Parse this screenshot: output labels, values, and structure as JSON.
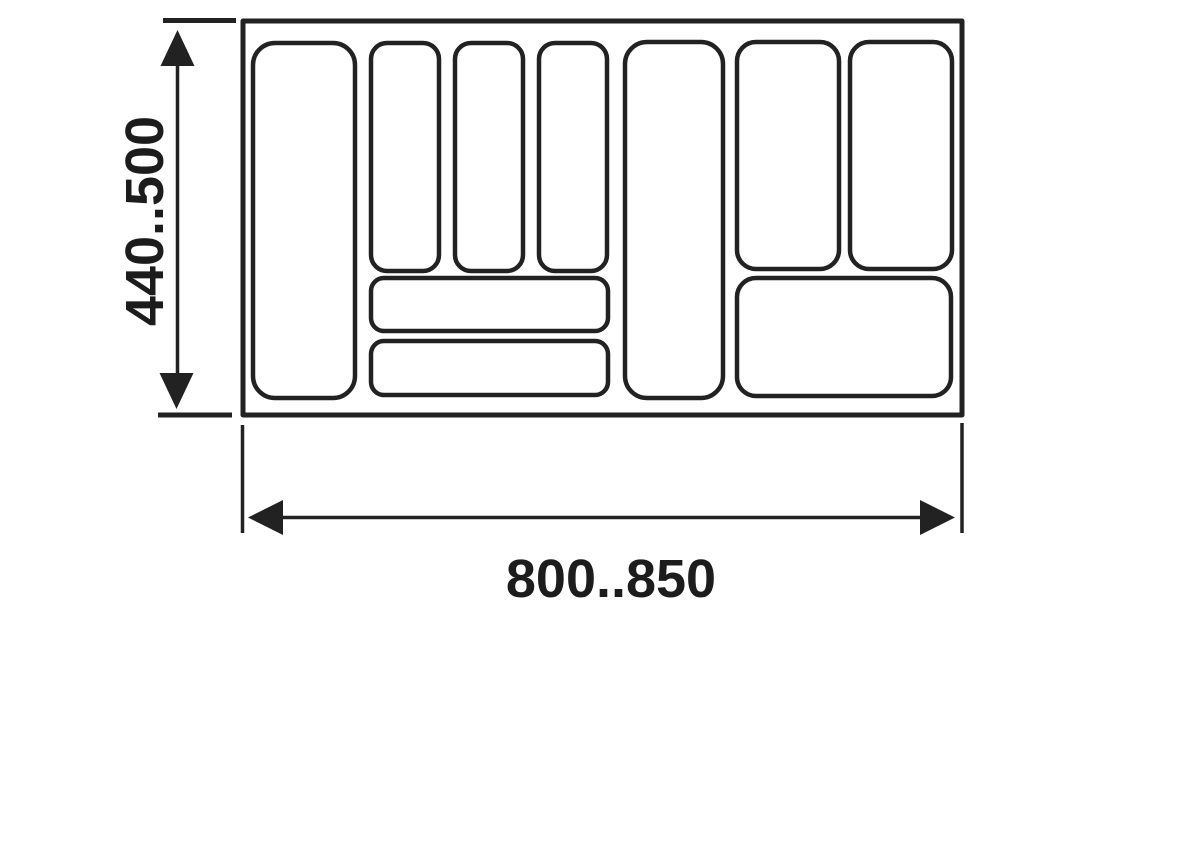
{
  "colors": {
    "background": "#ffffff",
    "line": "#222222",
    "text": "#1c1c1c"
  },
  "dimensions": {
    "height_label": "440..500",
    "width_label": "800..850"
  },
  "drawing": {
    "tray": {
      "x": 243,
      "y": 21,
      "width": 719,
      "height": 394
    },
    "compartments": [
      {
        "id": "left-tall",
        "x": 253,
        "y": 43,
        "width": 102,
        "height": 355,
        "radius": 22
      },
      {
        "id": "top-narrow-1",
        "x": 371,
        "y": 43,
        "width": 68,
        "height": 228,
        "radius": 16
      },
      {
        "id": "top-narrow-2",
        "x": 455,
        "y": 43,
        "width": 68,
        "height": 228,
        "radius": 16
      },
      {
        "id": "top-narrow-3",
        "x": 539,
        "y": 43,
        "width": 68,
        "height": 228,
        "radius": 16
      },
      {
        "id": "shallow-wide-1",
        "x": 371,
        "y": 278,
        "width": 237,
        "height": 53,
        "radius": 13
      },
      {
        "id": "shallow-wide-2",
        "x": 371,
        "y": 341,
        "width": 237,
        "height": 54,
        "radius": 13
      },
      {
        "id": "middle-tall",
        "x": 625,
        "y": 42,
        "width": 98,
        "height": 356,
        "radius": 22
      },
      {
        "id": "right-top-1",
        "x": 737,
        "y": 42,
        "width": 102,
        "height": 227,
        "radius": 19
      },
      {
        "id": "right-top-2",
        "x": 850,
        "y": 42,
        "width": 102,
        "height": 227,
        "radius": 19
      },
      {
        "id": "right-wide",
        "x": 737,
        "y": 278,
        "width": 214,
        "height": 118,
        "radius": 19
      }
    ]
  }
}
